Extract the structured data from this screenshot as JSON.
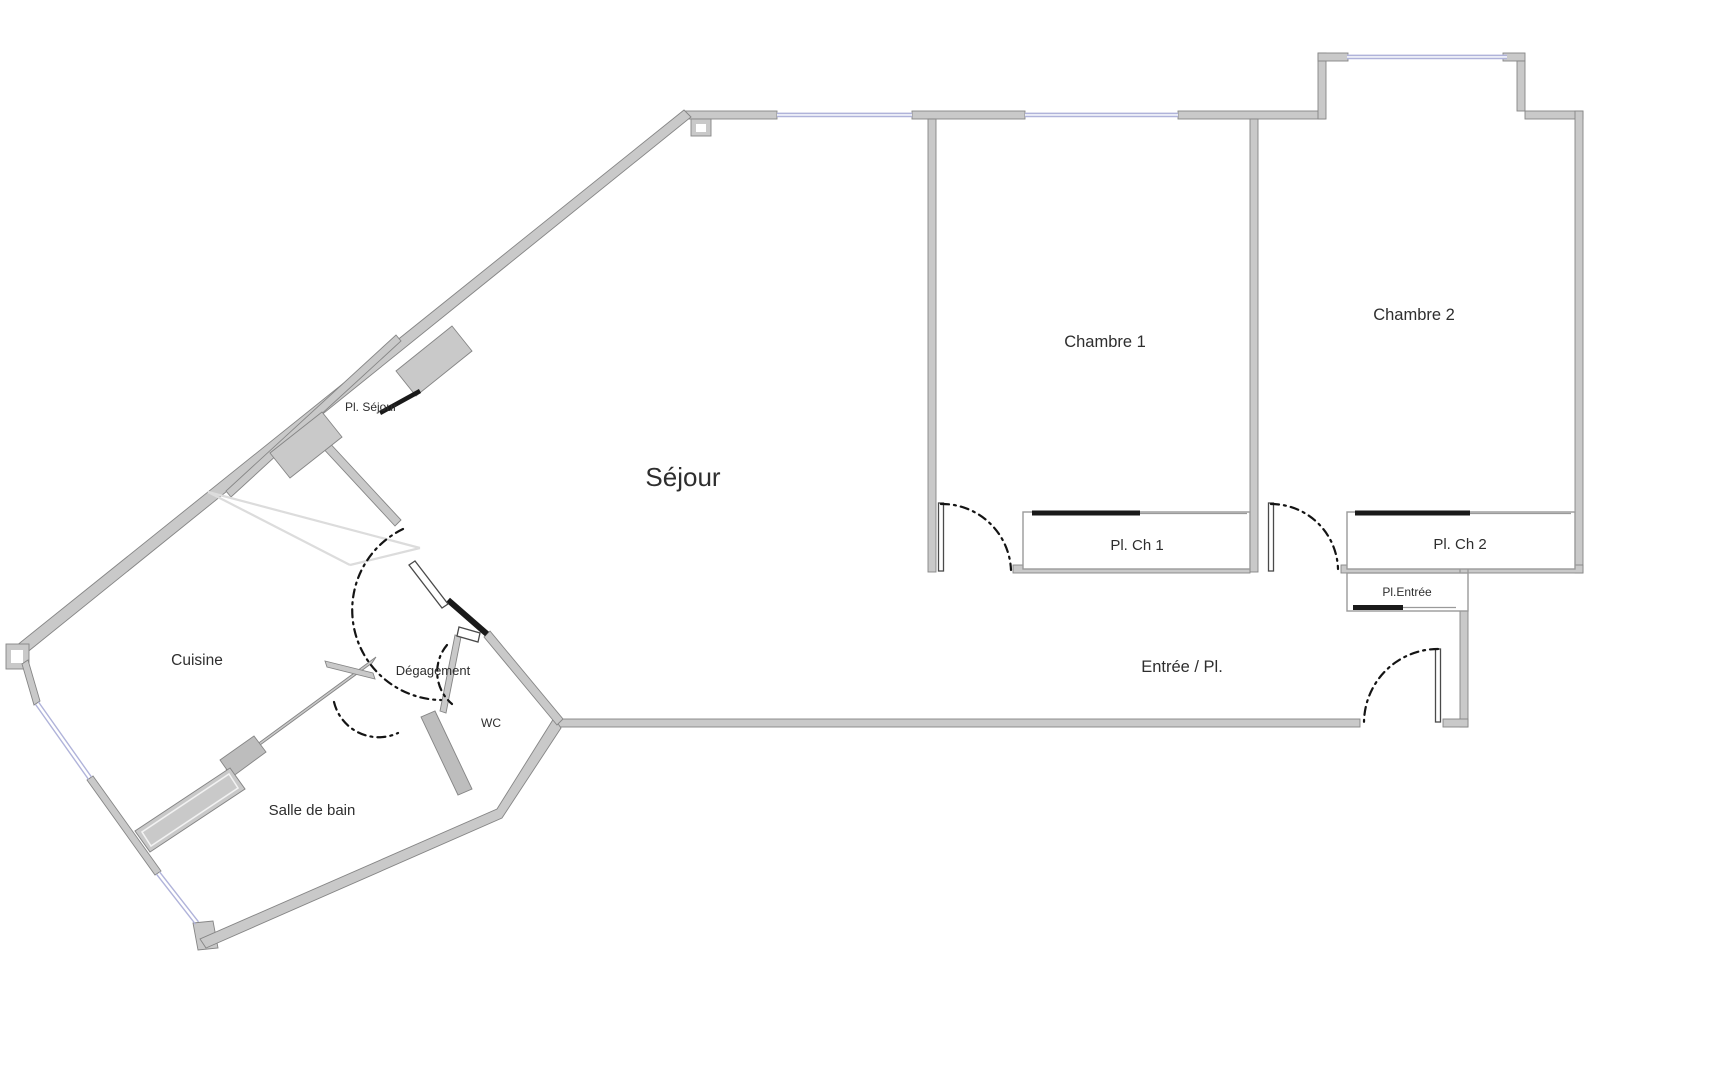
{
  "plan_type": "apartment-floor-plan",
  "colors": {
    "background": "#ffffff",
    "wall_fill": "#c9c9c9",
    "wall_edge": "#858585",
    "wall_dark": "#bdbdbd",
    "window": "#b0b3da",
    "window_fill": "#eceef7",
    "arc": "#141414",
    "closet_front": "#1a1a1a",
    "closet_stroke": "#9a9a9a",
    "leaf_stroke": "#4a4a4a",
    "hatch": "#dcdcdc",
    "text": "#2e2e2e"
  },
  "labels": {
    "sejour": "Séjour",
    "chambre1": "Chambre 1",
    "chambre2": "Chambre 2",
    "pl_ch1": "Pl. Ch 1",
    "pl_ch2": "Pl. Ch 2",
    "pl_entree": "Pl.Entrée",
    "entree": "Entrée / Pl.",
    "cuisine": "Cuisine",
    "degagement": "Dégagement",
    "wc": "WC",
    "salle_de_bain": "Salle de bain",
    "pl_sejour": "Pl. Séjour"
  }
}
